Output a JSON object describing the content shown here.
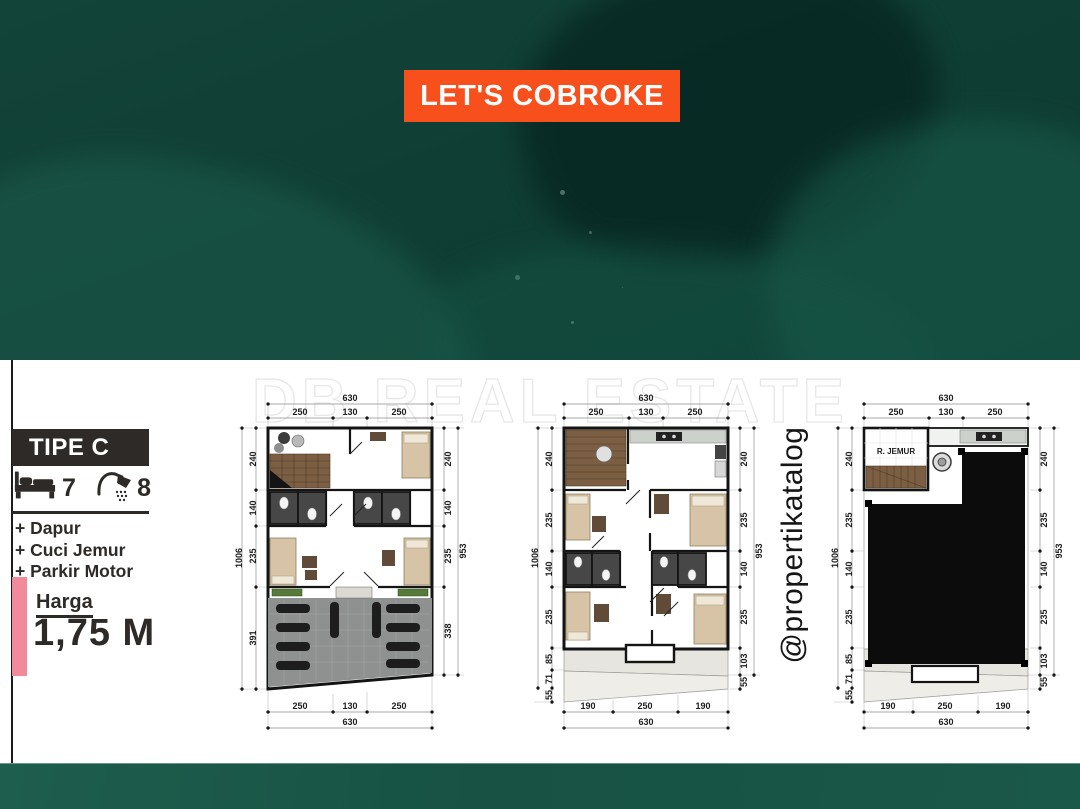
{
  "banner": {
    "label": "LET'S COBROKE",
    "bg": "#f8501d"
  },
  "watermark": "DB REAL ESTATE",
  "social_handle": "@propertikatalog",
  "sidebar": {
    "type_label": "TIPE C",
    "bedrooms": "7",
    "bathrooms": "8",
    "features": [
      "+ Dapur",
      "+ Cuci Jemur",
      "+ Parkir Motor"
    ],
    "price_label": "Harga",
    "price_value": "1,75 M"
  },
  "colors": {
    "teal_dark": "#0c3a30",
    "teal_footer": "#1a584a",
    "banner_orange": "#f8501d",
    "accent_pink": "#f18a9b",
    "ink": "#2d2a27"
  },
  "plans": [
    {
      "top_total": "630",
      "top_segments": [
        "250",
        "130",
        "250"
      ],
      "left_total": "1006",
      "left_segments": [
        "240",
        "140",
        "235",
        "391"
      ],
      "right_total": "953",
      "right_segments": [
        "240",
        "140",
        "235",
        "338"
      ],
      "bottom_segments": [
        "250",
        "130",
        "250"
      ],
      "bottom_total": "630"
    },
    {
      "top_total": "630",
      "top_segments": [
        "250",
        "130",
        "250"
      ],
      "left_total": "1006",
      "left_segments": [
        "240",
        "235",
        "140",
        "235",
        "85",
        "71",
        "55"
      ],
      "right_total": "953",
      "right_segments": [
        "240",
        "235",
        "140",
        "235",
        "103",
        "55"
      ],
      "bottom_segments": [
        "190",
        "250",
        "190"
      ],
      "bottom_total": "630"
    },
    {
      "top_total": "630",
      "top_segments": [
        "250",
        "130",
        "250"
      ],
      "left_total": "1006",
      "left_segments": [
        "240",
        "235",
        "140",
        "235",
        "85",
        "71",
        "55"
      ],
      "right_total": "953",
      "right_segments": [
        "240",
        "235",
        "140",
        "235",
        "103",
        "55"
      ],
      "bottom_segments": [
        "190",
        "250",
        "190"
      ],
      "bottom_total": "630",
      "room_label": "R. JEMUR"
    }
  ]
}
